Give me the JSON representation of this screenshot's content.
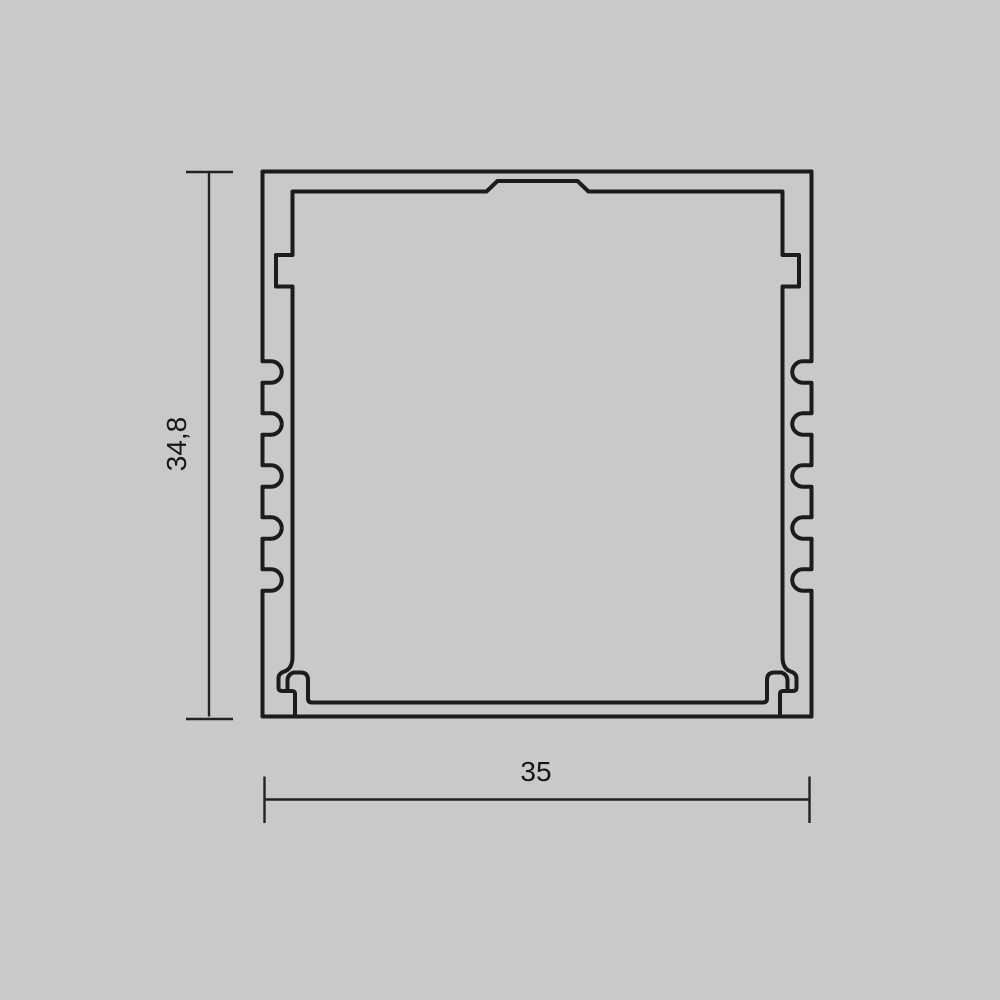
{
  "page": {
    "type": "technical-drawing",
    "description": "Cross-section dimensional drawing of a square aluminium LED profile",
    "background_color": "#c9c9c9",
    "line_color": "#1c1c1c",
    "text_color": "#161616"
  },
  "drawing": {
    "profile": {
      "outer_width_units": 35,
      "outer_height_units": 34.8,
      "side_grooves_per_wall": 5,
      "features": [
        "outer-square-contour",
        "inner-cavity-contour",
        "top-center-plateau",
        "upper-wall-notches",
        "bottom-diffuser-hooks"
      ]
    },
    "dimensions": {
      "height": {
        "label": "34,8",
        "orientation": "vertical"
      },
      "width": {
        "label": "35",
        "orientation": "horizontal"
      }
    }
  }
}
